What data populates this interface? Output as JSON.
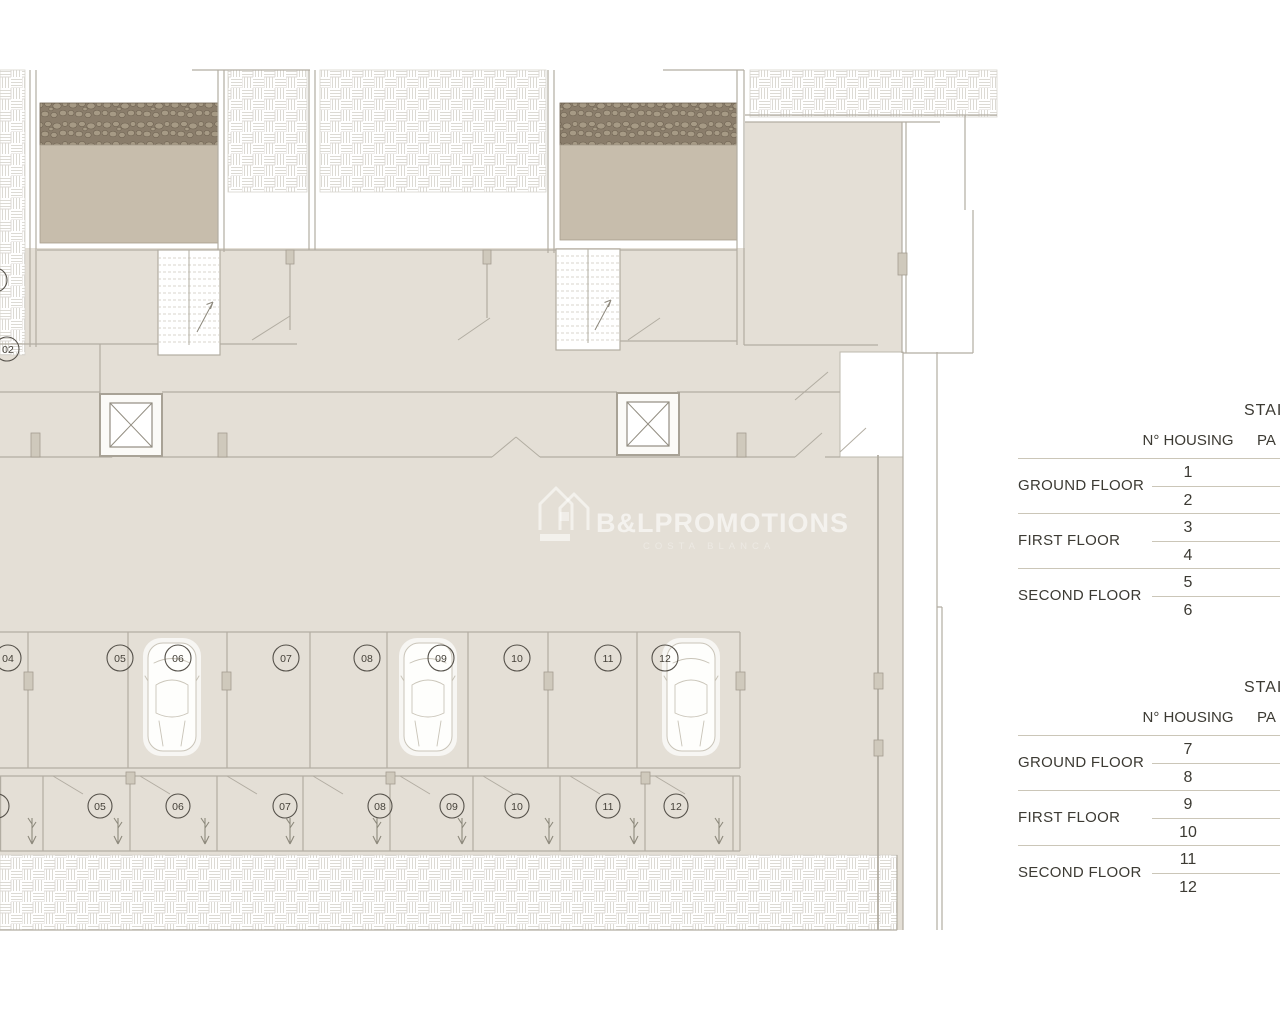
{
  "watermark": {
    "brand": "B&LPROMOTIONS",
    "subtitle": "COSTA BLANCA"
  },
  "plan": {
    "level_circle": "02",
    "parking_spaces": [
      {
        "label": "04",
        "car": false
      },
      {
        "label": "05",
        "car": false
      },
      {
        "label": "06",
        "car": true
      },
      {
        "label": "07",
        "car": false
      },
      {
        "label": "08",
        "car": false
      },
      {
        "label": "09",
        "car": true
      },
      {
        "label": "10",
        "car": false
      },
      {
        "label": "11",
        "car": false
      },
      {
        "label": "12",
        "car": true
      }
    ],
    "storage_rooms": [
      {
        "label": "05"
      },
      {
        "label": "06"
      },
      {
        "label": "07"
      },
      {
        "label": "08"
      },
      {
        "label": "09"
      },
      {
        "label": "10"
      },
      {
        "label": "11"
      },
      {
        "label": "12"
      }
    ]
  },
  "tables": [
    {
      "title": "STAI",
      "housing_header": "N° HOUSING",
      "parking_header": "PA",
      "groups": [
        {
          "floor": "GROUND FLOOR",
          "units": [
            "1",
            "2"
          ]
        },
        {
          "floor": "FIRST FLOOR",
          "units": [
            "3",
            "4"
          ]
        },
        {
          "floor": "SECOND FLOOR",
          "units": [
            "5",
            "6"
          ]
        }
      ]
    },
    {
      "title": "STAI",
      "housing_header": "N° HOUSING",
      "parking_header": "PA",
      "groups": [
        {
          "floor": "GROUND FLOOR",
          "units": [
            "7",
            "8"
          ]
        },
        {
          "floor": "FIRST FLOOR",
          "units": [
            "9",
            "10"
          ]
        },
        {
          "floor": "SECOND FLOOR",
          "units": [
            "11",
            "12"
          ]
        }
      ]
    }
  ],
  "colors": {
    "floor": "#e4dfd6",
    "terrace": "#c7bdac",
    "rubble": "#8a7d6b",
    "rule": "#cbc6b8",
    "text": "#3c3a33"
  }
}
